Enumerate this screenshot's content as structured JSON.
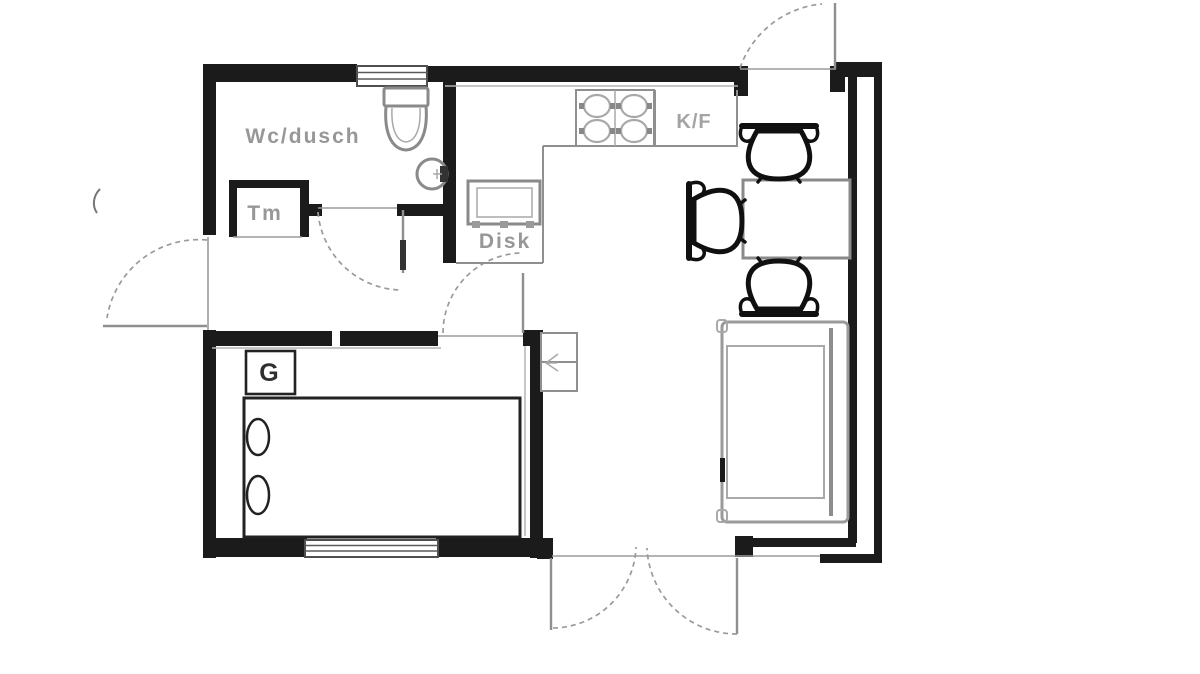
{
  "labels": {
    "bathroom": "Wc/dusch",
    "closet": "Tm",
    "sink_bench": "Disk",
    "fridge_freezer": "K/F",
    "wardrobe": "G"
  },
  "colors": {
    "wall": "#1b1b1b",
    "fixture_outline": "#8a8a8a",
    "furniture_black": "#101010",
    "sofa_outline": "#9a9a9a",
    "door_arc": "#9a9a9a",
    "label_text": "#979797",
    "wardrobe_label_text": "#2f2f2f",
    "background": "#ffffff"
  },
  "fixtures": [
    "toilet",
    "washbasin",
    "stove-4-burners",
    "fridge-freezer",
    "sink-bench",
    "dining-table",
    "dining-chair",
    "dining-chair",
    "dining-chair",
    "sofa",
    "bed",
    "pillow",
    "pillow",
    "wardrobe",
    "service-shaft",
    "window-bathroom",
    "window-bedroom",
    "entry-door",
    "left-exit-door",
    "bathroom-door",
    "bedroom-door",
    "patio-double-door"
  ]
}
